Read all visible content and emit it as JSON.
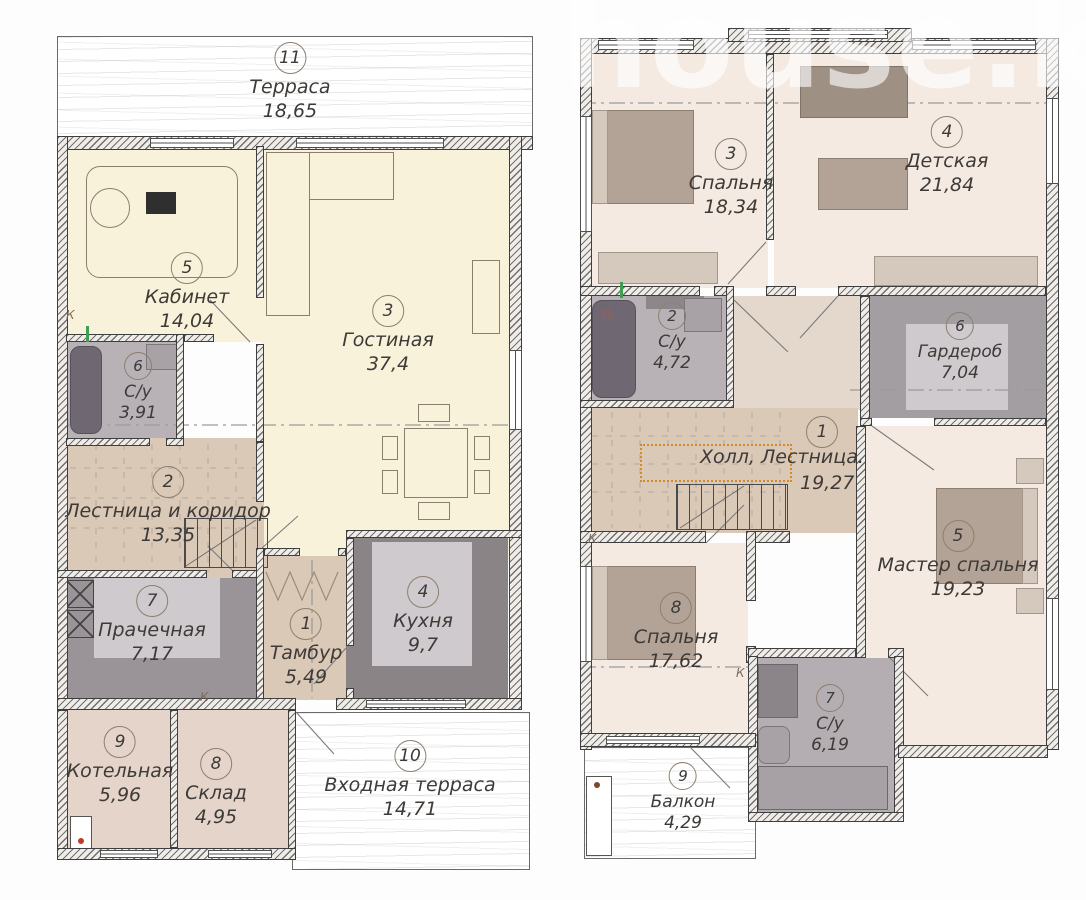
{
  "watermark": "house.k",
  "floor1": {
    "rooms": [
      {
        "num": "11",
        "name": "Терраса",
        "area": "18,65"
      },
      {
        "num": "5",
        "name": "Кабинет",
        "area": "14,04"
      },
      {
        "num": "3",
        "name": "Гостиная",
        "area": "37,4"
      },
      {
        "num": "6",
        "name": "С/у",
        "area": "3,91"
      },
      {
        "num": "2",
        "name": "Лестница и коридор",
        "area": "13,35"
      },
      {
        "num": "7",
        "name": "Прачечная",
        "area": "7,17"
      },
      {
        "num": "1",
        "name": "Тамбур",
        "area": "5,49"
      },
      {
        "num": "4",
        "name": "Кухня",
        "area": "9,7"
      },
      {
        "num": "9",
        "name": "Котельная",
        "area": "5,96"
      },
      {
        "num": "8",
        "name": "Склад",
        "area": "4,95"
      },
      {
        "num": "10",
        "name": "Входная терраса",
        "area": "14,71"
      }
    ]
  },
  "floor2": {
    "rooms": [
      {
        "num": "3",
        "name": "Спальня",
        "area": "18,34"
      },
      {
        "num": "4",
        "name": "Детская",
        "area": "21,84"
      },
      {
        "num": "2",
        "name": "С/у",
        "area": "4,72"
      },
      {
        "num": "6",
        "name": "Гардероб",
        "area": "7,04"
      },
      {
        "num": "1",
        "name": "Холл,  Лестница.",
        "area": "19,27"
      },
      {
        "num": "5",
        "name": "Мастер спальня",
        "area": "19,23"
      },
      {
        "num": "8",
        "name": "Спальня",
        "area": "17,62"
      },
      {
        "num": "7",
        "name": "С/у",
        "area": "6,19"
      },
      {
        "num": "9",
        "name": "Балкон",
        "area": "4,29"
      }
    ]
  },
  "annotations": {
    "k": "К",
    "k_dot": "К.",
    "p": "П."
  },
  "colors": {
    "cream_room": "#f9f2da",
    "beige_hall": "#dbc9b7",
    "bedroom_pink": "#f5eae2",
    "grey_bath": "#b8b2b6",
    "dark_grey_kitchen": "#8a8487",
    "pink_beige_storage": "#e5d4ca",
    "taupe_furniture": "#b2a396",
    "railing_orange": "#d5892b",
    "wall_dark": "#3e3e3e"
  }
}
